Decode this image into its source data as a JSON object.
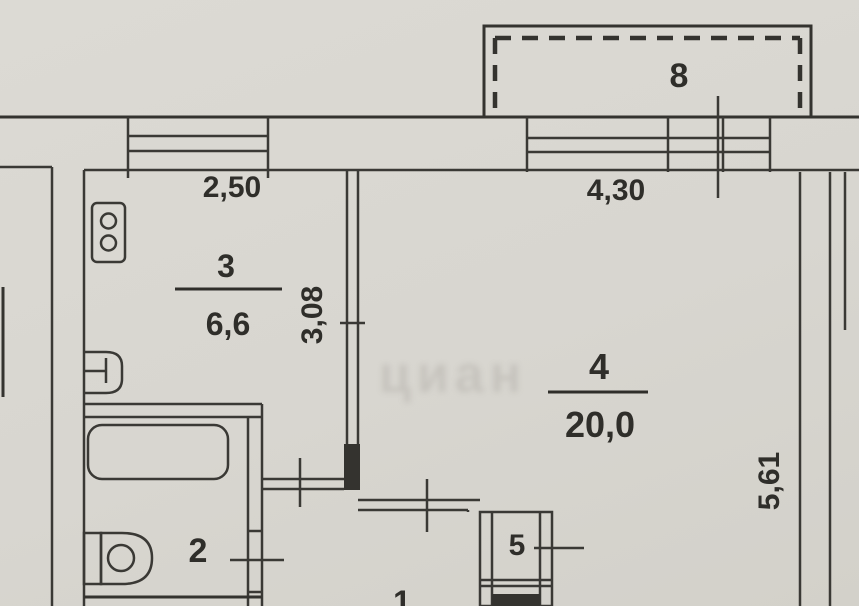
{
  "plan": {
    "type": "apartment-floor-plan-scan",
    "colors": {
      "paper": "#d8d6d0",
      "ink": "#3a3935"
    },
    "rooms": [
      {
        "number": "1",
        "name": "hallway",
        "area": ""
      },
      {
        "number": "2",
        "name": "bathroom",
        "area": ""
      },
      {
        "number": "3",
        "name": "kitchen",
        "area": "6,6"
      },
      {
        "number": "4",
        "name": "living-room",
        "area": "20,0"
      },
      {
        "number": "5",
        "name": "closet",
        "area": ""
      },
      {
        "number": "8",
        "name": "balcony",
        "area": ""
      }
    ],
    "dimensions": {
      "kitchen_window_width": "2,50",
      "living_window_width": "4,30",
      "kitchen_wall_depth": "3,08",
      "living_wall_depth": "5,61"
    },
    "fixtures": [
      "stove",
      "sink",
      "bathtub",
      "toilet"
    ],
    "watermark": "циан"
  }
}
